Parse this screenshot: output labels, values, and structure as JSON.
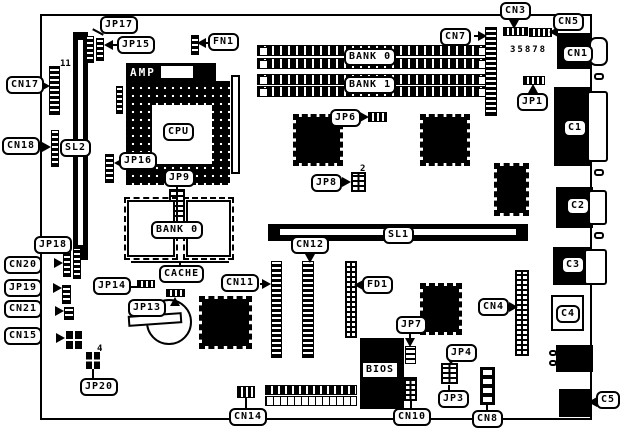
{
  "labels": {
    "jp17": "JP17",
    "jp15": "JP15",
    "fn1": "FN1",
    "cn3": "CN3",
    "cn5": "CN5",
    "cn7": "CN7",
    "cn1": "CN1",
    "jp1": "JP1",
    "c1": "C1",
    "c2": "C2",
    "c3": "C3",
    "c4": "C4",
    "c5": "C5",
    "amp": "AMP",
    "cpu": "CPU",
    "simm_bank0": "BANK 0",
    "simm_bank1": "BANK 1",
    "jp6": "JP6",
    "jp8": "JP8",
    "cn17": "CN17",
    "cn18": "CN18",
    "sl2": "SL2",
    "jp16": "JP16",
    "jp9": "JP9",
    "cache_bank0": "BANK 0",
    "cache": "CACHE",
    "jp18": "JP18",
    "cn20": "CN20",
    "jp19": "JP19",
    "cn21": "CN21",
    "cn15": "CN15",
    "jp20": "JP20",
    "jp14": "JP14",
    "jp13": "JP13",
    "cn11": "CN11",
    "cn12": "CN12",
    "sl1": "SL1",
    "fd1": "FD1",
    "cn4": "CN4",
    "jp7": "JP7",
    "jp4": "JP4",
    "jp3": "JP3",
    "cn8": "CN8",
    "cn10": "CN10",
    "bios": "BIOS",
    "cn14": "CN14"
  },
  "annotations": {
    "board_number": "35878",
    "pin11": "11",
    "pin2": "2",
    "pin4": "4"
  }
}
